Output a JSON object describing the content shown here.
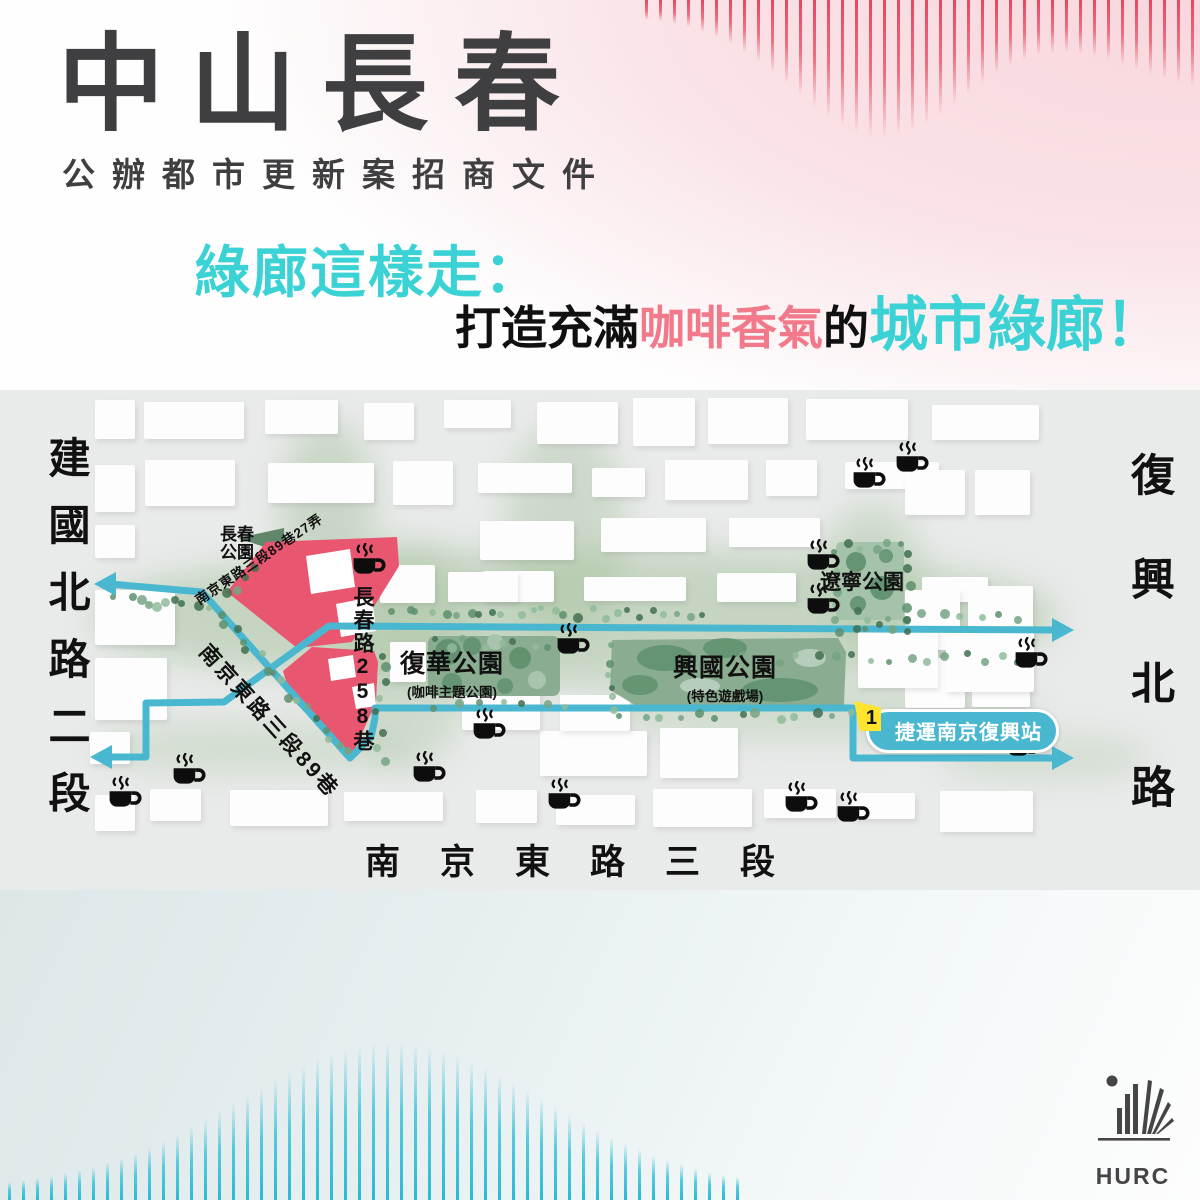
{
  "header": {
    "title": "中山長春",
    "subtitle": "公辦都市更新案招商文件",
    "tagline": "綠廊這樣走：",
    "slogan": {
      "part1": "打造充滿",
      "part2": "咖啡香氣",
      "part3": "的",
      "part4": "城市綠廊！"
    }
  },
  "map": {
    "roads": {
      "left_vertical": "建國北路二段",
      "right_vertical": "復興北路",
      "bottom": "南京東路三段",
      "diagonal_small": "南京東路三段89巷27弄",
      "diagonal_large": "南京東路三段89巷",
      "vertical_lane": "長春路258巷"
    },
    "parks": {
      "changchun": {
        "name_line1": "長春",
        "name_line2": "公園"
      },
      "fuhua": {
        "name": "復華公園",
        "subtitle": "(咖啡主題公園)"
      },
      "xingguo": {
        "name": "興國公園",
        "subtitle": "(特色遊戲場)"
      },
      "liaoning": {
        "name": "遼寧公園"
      }
    },
    "mrt": {
      "line_number": "1",
      "station": "捷運南京復興站"
    }
  },
  "footer": {
    "logo_text": "HURC"
  },
  "colors": {
    "title_dark": "#3f3f41",
    "accent_teal": "#3bd2d6",
    "accent_pink": "#f1798a",
    "route_teal": "#4ab7d1",
    "site_pink": "#e8566f",
    "park_green": "#8aad91",
    "park_green_dark": "#5d8f6d",
    "mrt_yellow": "#ffe32e",
    "deco_pink": "#ec5a70",
    "deco_teal": "#2ec1d8"
  }
}
